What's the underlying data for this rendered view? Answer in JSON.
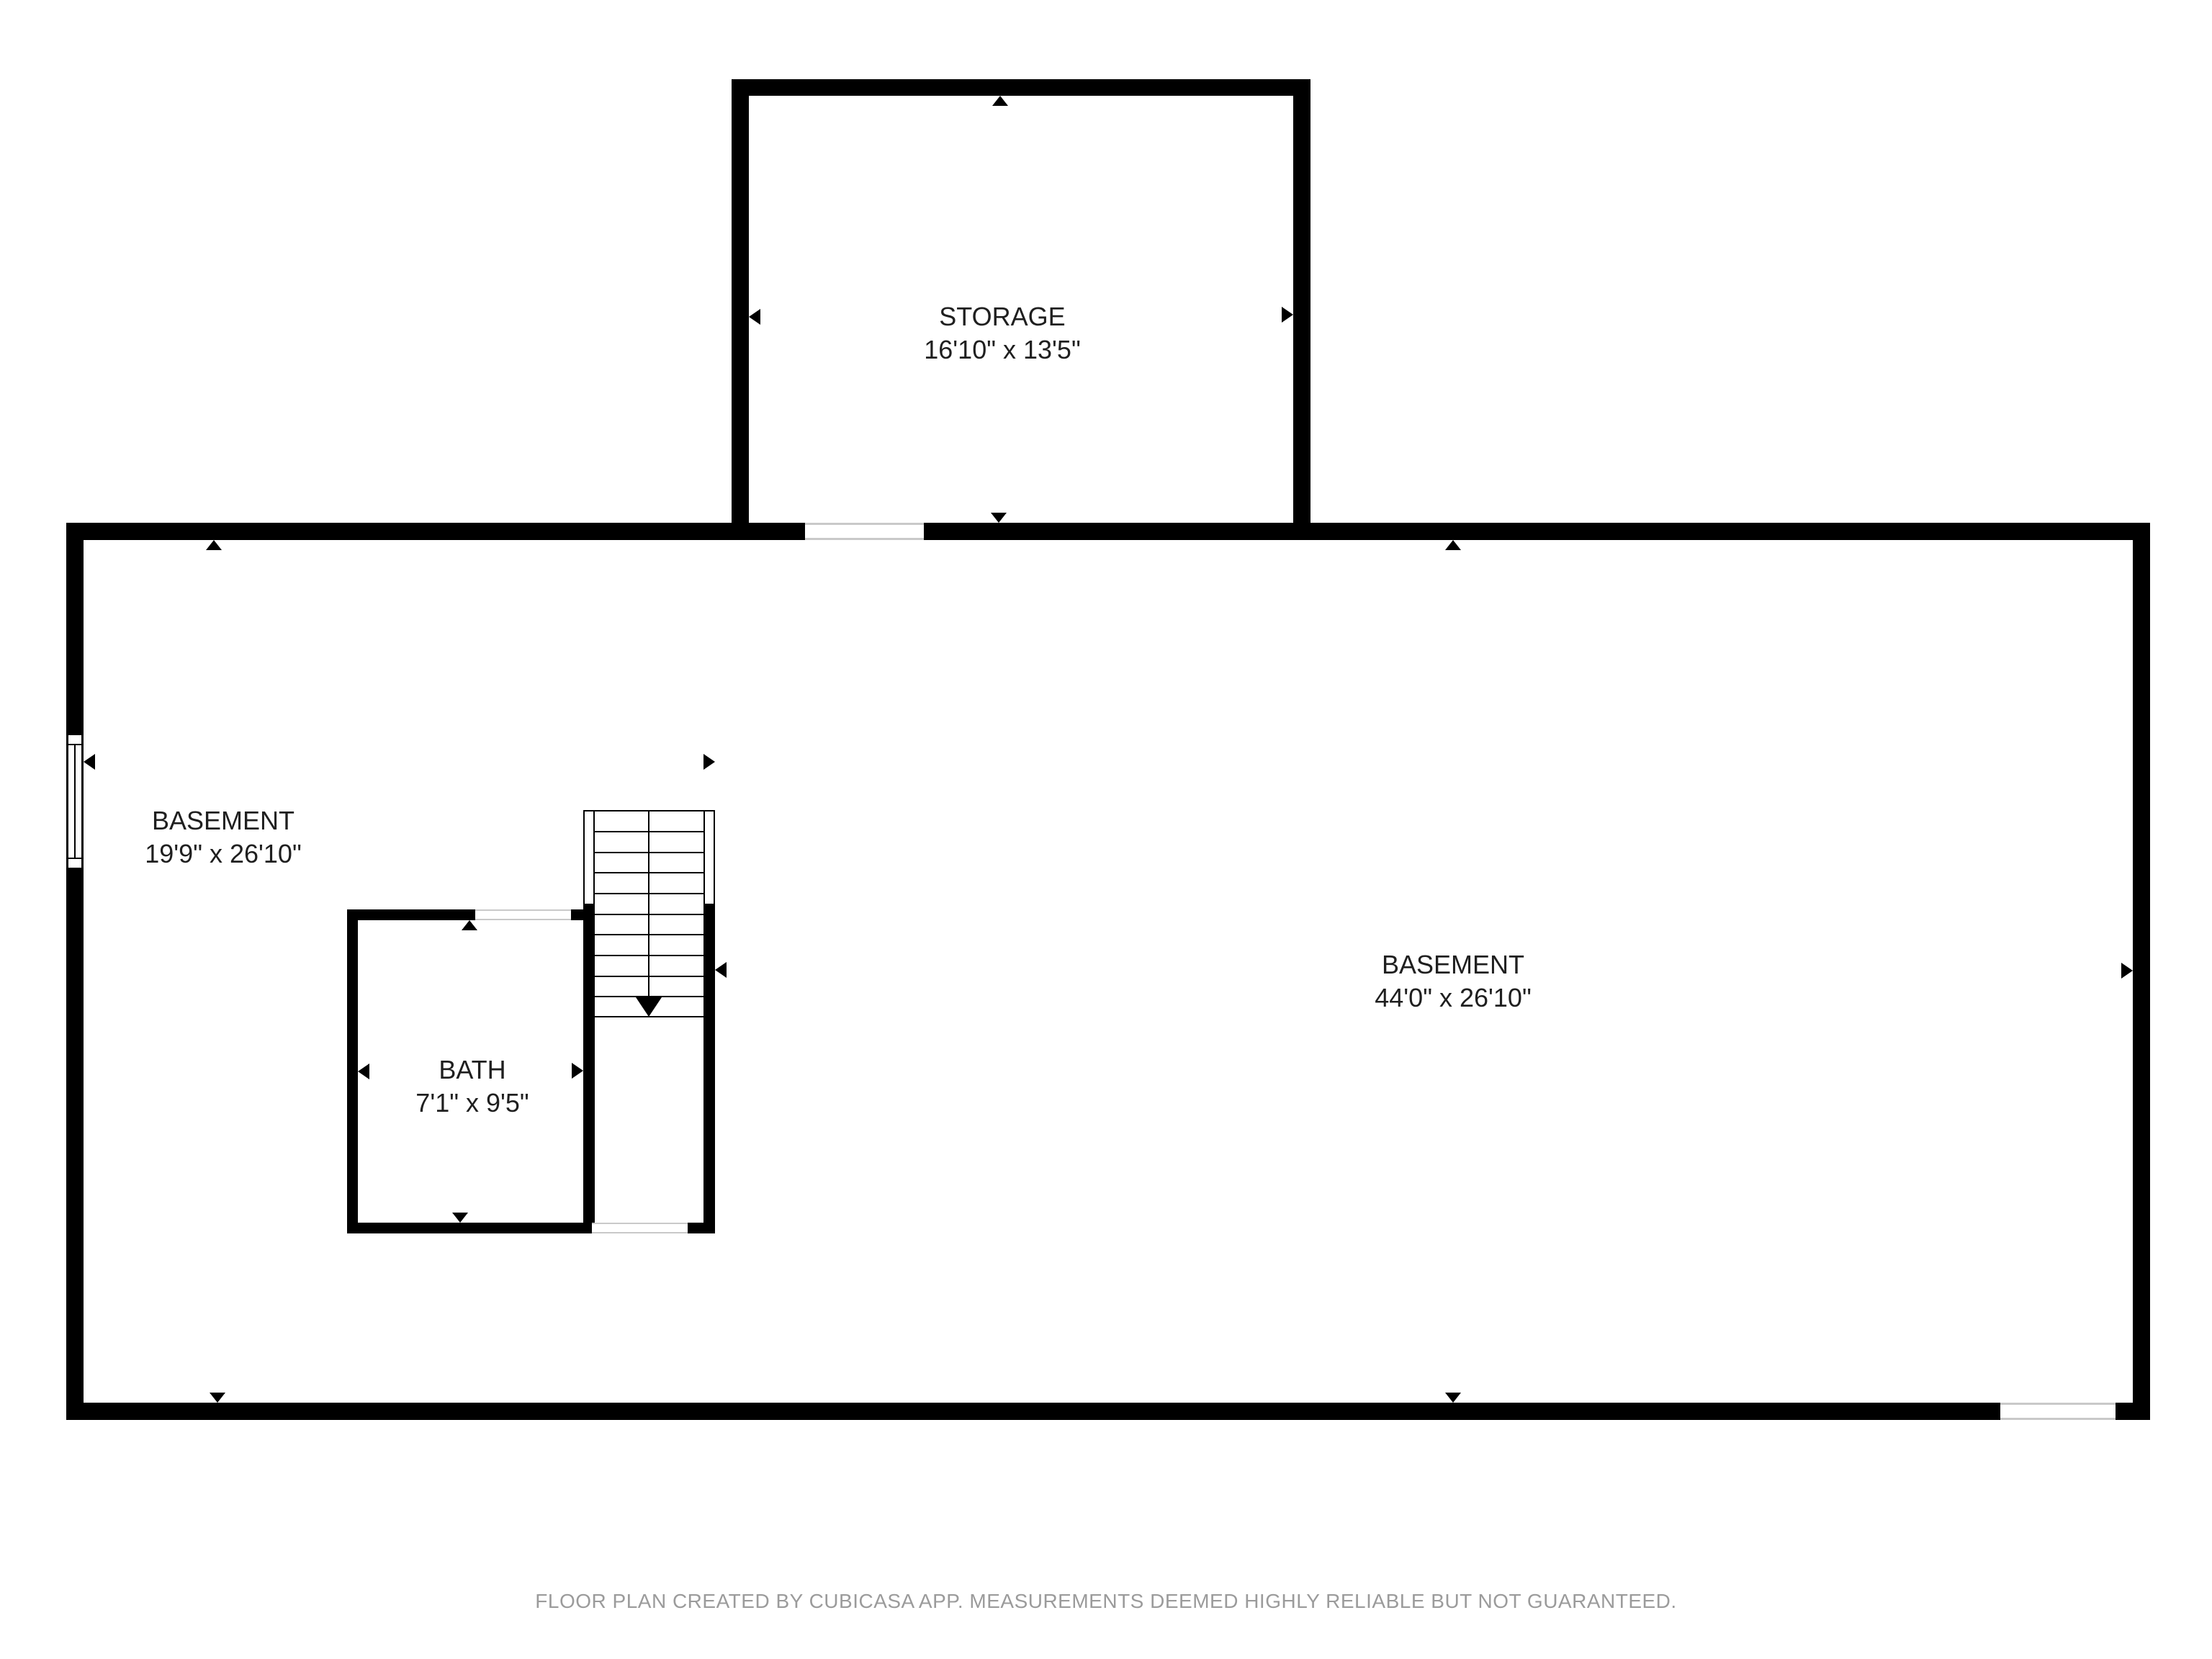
{
  "plan": {
    "creator_note": "FLOOR PLAN CREATED BY CUBICASA APP. MEASUREMENTS DEEMED HIGHLY RELIABLE BUT NOT GUARANTEED."
  },
  "rooms": {
    "storage": {
      "name": "STORAGE",
      "dims": "16'10\" x 13'5\""
    },
    "basement_left": {
      "name": "BASEMENT",
      "dims": "19'9\" x 26'10\""
    },
    "basement_main": {
      "name": "BASEMENT",
      "dims": "44'0\" x 26'10\""
    },
    "bath": {
      "name": "BATH",
      "dims": "7'1\" x 9'5\""
    }
  },
  "colors": {
    "wall": "#000000",
    "background": "#ffffff",
    "opening_line": "#c9c9c9",
    "label_text": "#1f1f1f",
    "footer_text": "#9b9b9b"
  }
}
